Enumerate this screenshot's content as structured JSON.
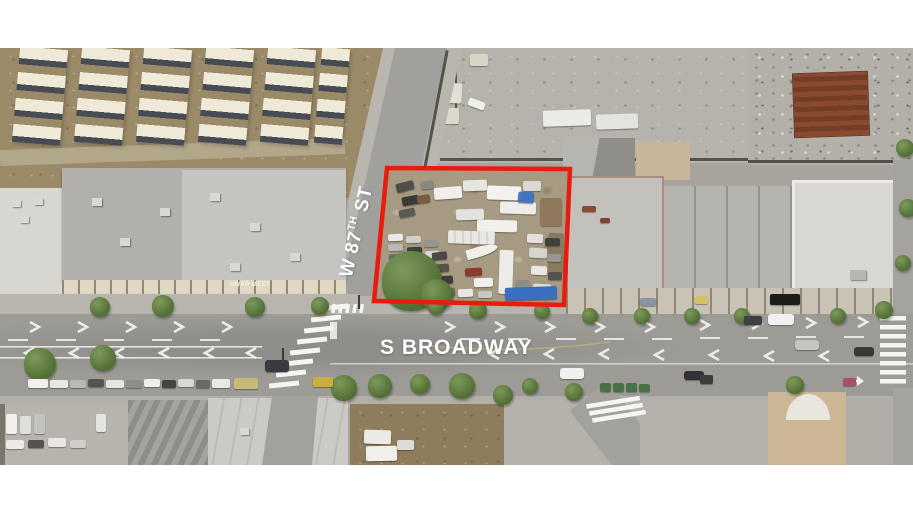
{
  "page": {
    "background_color": "#ffffff"
  },
  "aerial_photo": {
    "description": "Oblique aerial photograph of a red-outlined corner parcel (vehicle storage yard) at W 87th St and S Broadway",
    "labels": {
      "w_87th_st": {
        "prefix": "W 87",
        "superscript": "TH",
        "suffix": " ST"
      },
      "s_broadway": "S BROADWAY",
      "building_sign": "SWAP MEET"
    },
    "colors": {
      "parcel_outline": "#ea1a0e",
      "street_label": "#ffffff",
      "tarp_blue": "#3a6fc0",
      "tree_green": "#5e7c40",
      "road": "#9c9b96",
      "dirt": "#9a8a68",
      "roof_gray": "#b1b0ac"
    }
  }
}
